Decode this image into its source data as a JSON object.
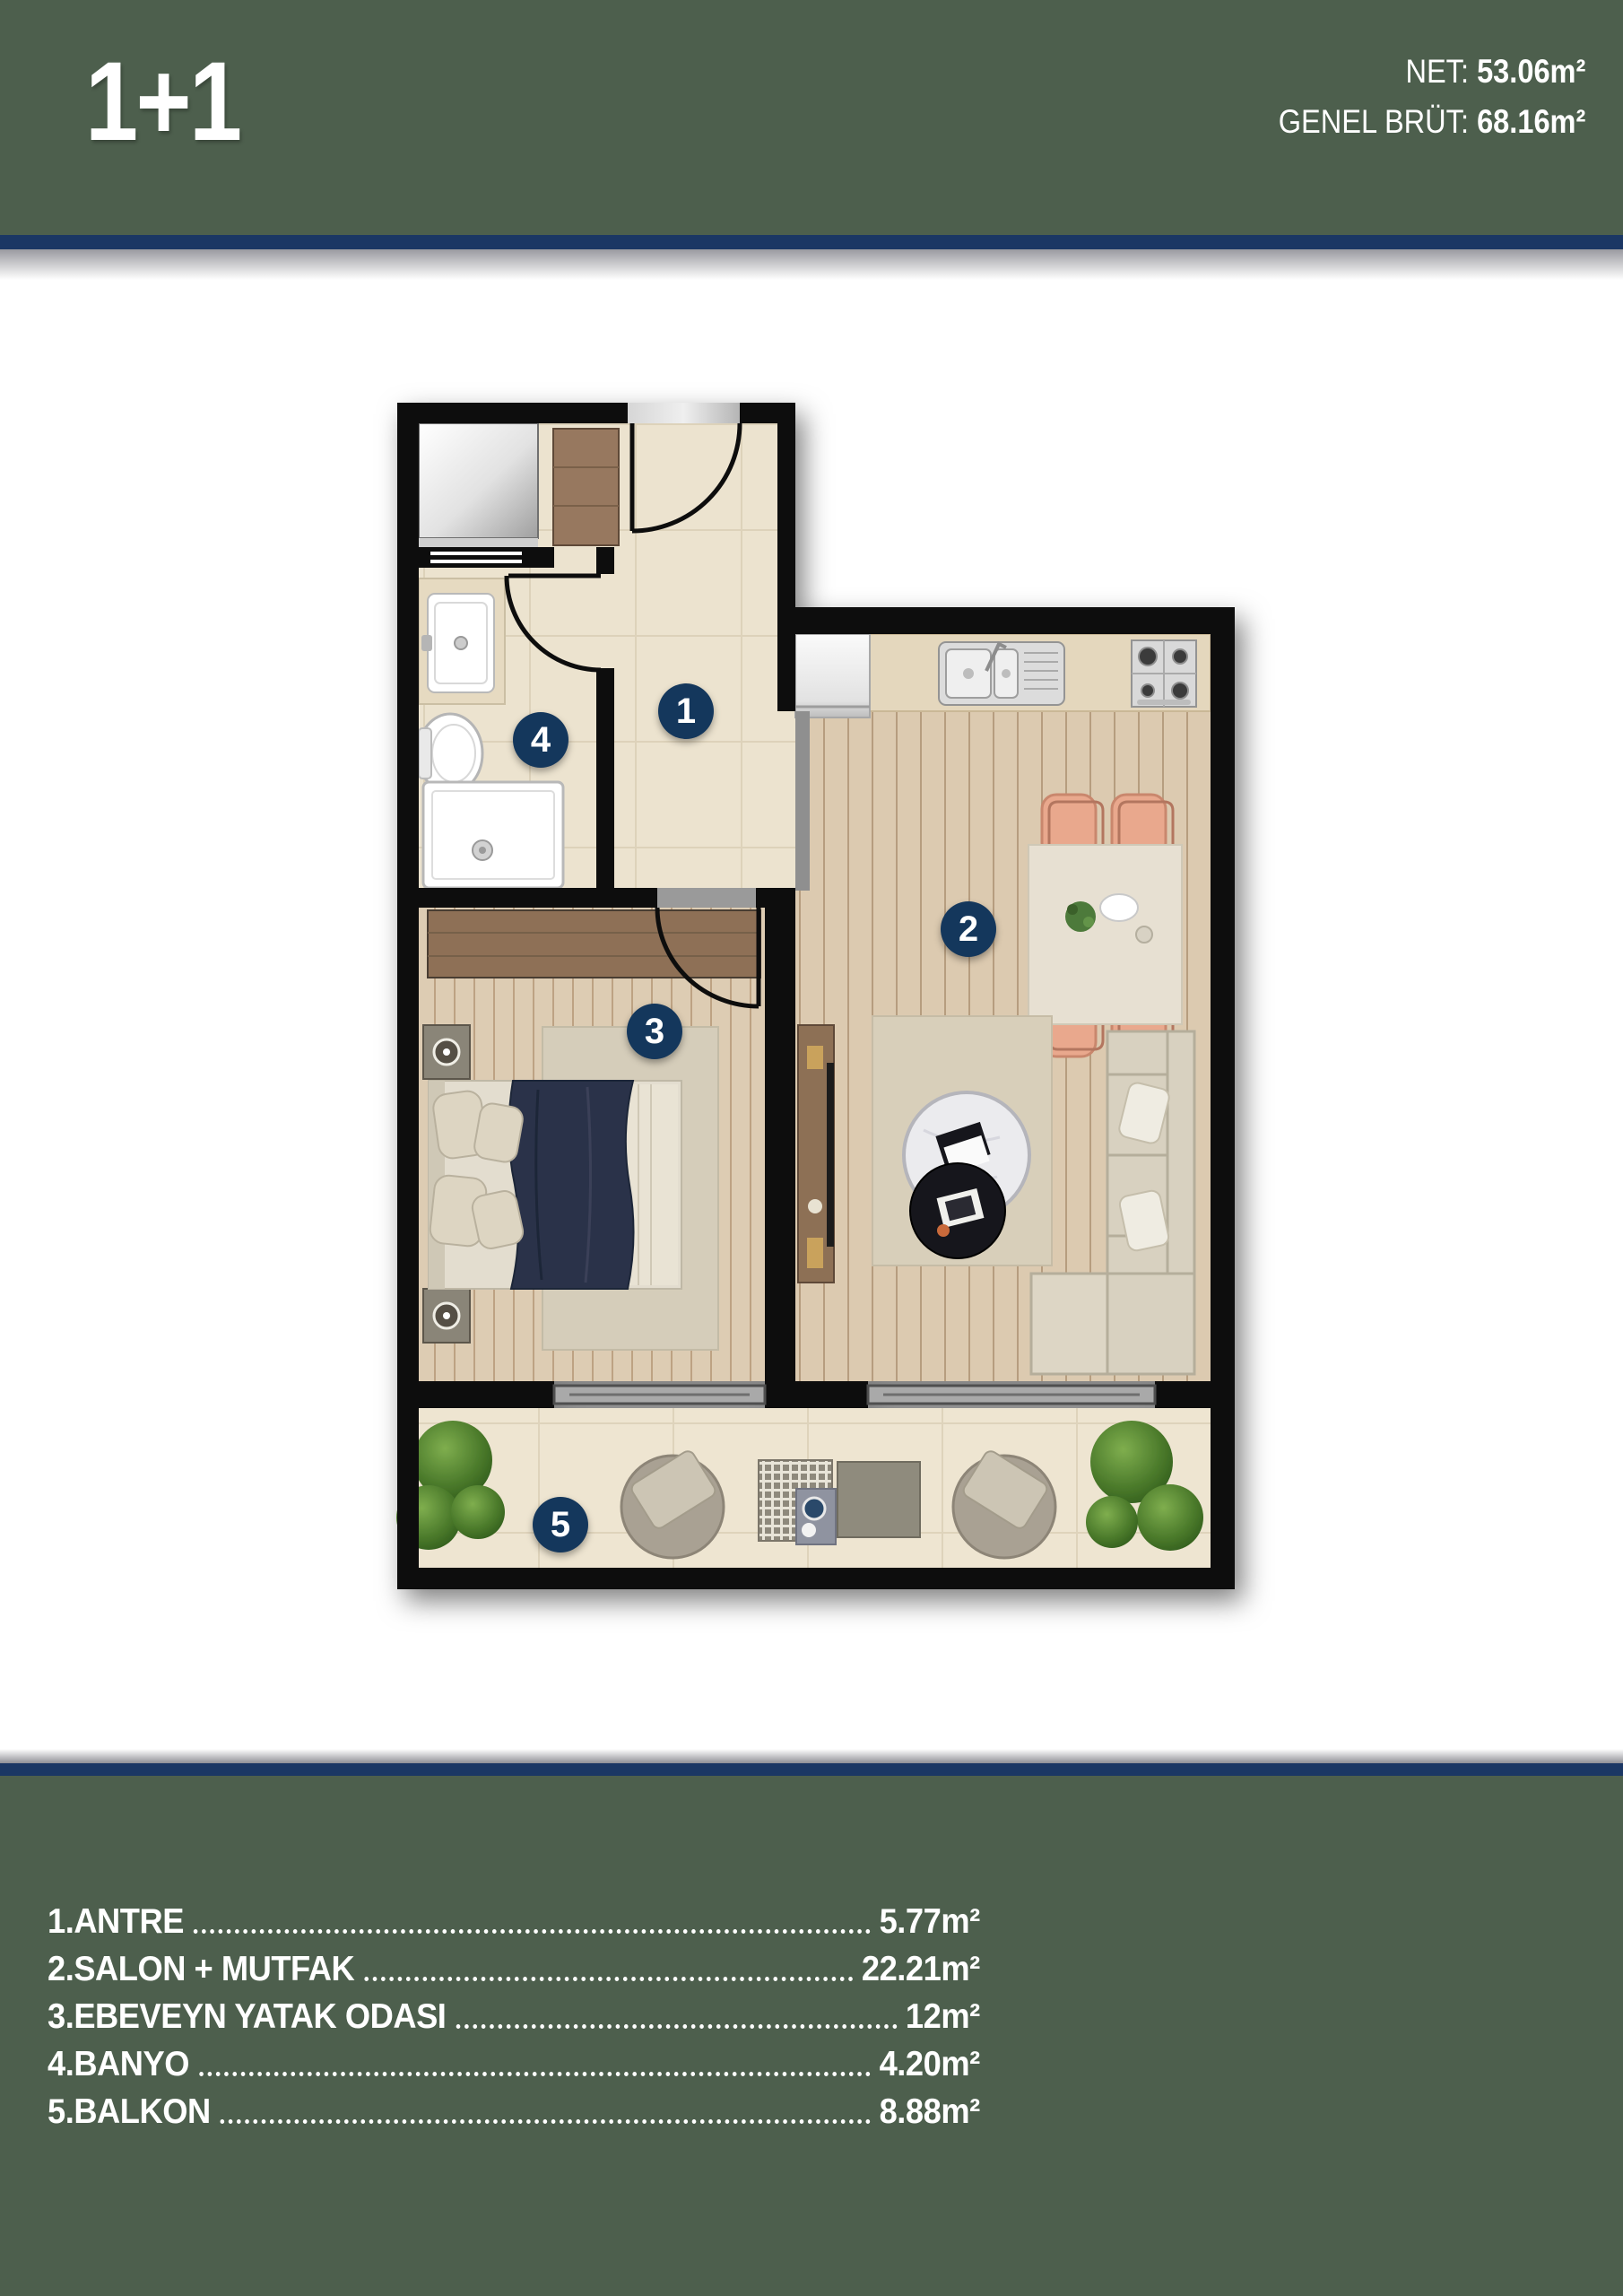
{
  "header": {
    "title": "1+1",
    "net_label": "NET:",
    "net_value": "53.06m²",
    "brut_label": "GENEL BRÜT:",
    "brut_value": "68.16m²"
  },
  "plan": {
    "badges": [
      {
        "number": "1",
        "room": "antre"
      },
      {
        "number": "2",
        "room": "salon-mutfak"
      },
      {
        "number": "3",
        "room": "ebeveyn-yatak-odasi"
      },
      {
        "number": "4",
        "room": "banyo"
      },
      {
        "number": "5",
        "room": "balkon"
      }
    ]
  },
  "legend": {
    "items": [
      {
        "label": "1.ANTRE",
        "value": "5.77m²"
      },
      {
        "label": "2.SALON + MUTFAK",
        "value": "22.21m²"
      },
      {
        "label": "3.EBEVEYN YATAK ODASI",
        "value": "12m²"
      },
      {
        "label": "4.BANYO",
        "value": "4.20m²"
      },
      {
        "label": "5.BALKON",
        "value": "8.88m²"
      }
    ]
  },
  "colors": {
    "header_green": "#4d5f4d",
    "divider_navy": "#1b3764",
    "badge_navy": "#14375c",
    "wall_black": "#0e0e0e",
    "tile_cream": "#ece3cf",
    "wood_floor": "#dccab0",
    "keyplan_wall_blue": "#2d58a4",
    "keyplan_highlight_yellow": "#d9c667"
  }
}
